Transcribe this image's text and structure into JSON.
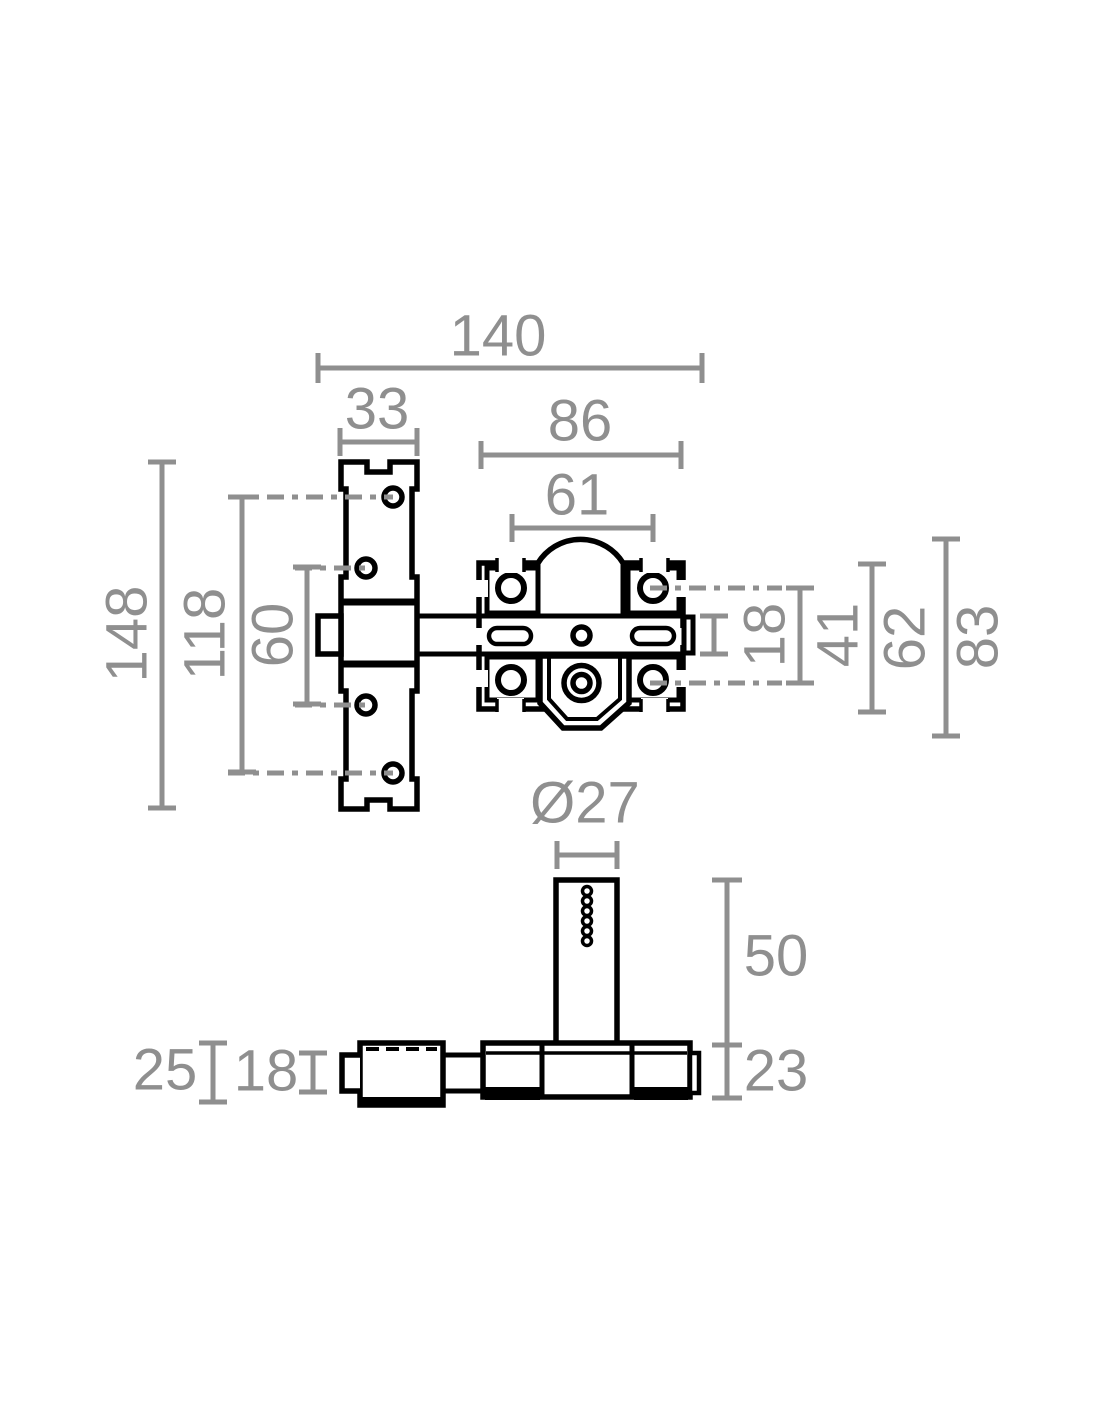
{
  "colors": {
    "ink": "#000000",
    "dimension_gray": "#8f8f8f",
    "background": "#ffffff"
  },
  "front_view": {
    "overall_width": "140",
    "keeper_plate_width": "33",
    "body_width": "86",
    "screw_spacing_horizontal": "61",
    "keeper_plate_height": "148",
    "outer_hole_spacing": "118",
    "inner_hole_spacing": "60",
    "bolt_height": "18",
    "screw_spacing_vertical": "41",
    "body_height": "62",
    "overall_height": "83"
  },
  "side_view": {
    "cylinder_diameter": "Ø27",
    "cylinder_height": "50",
    "bar_height": "23",
    "keeper_depth": "25",
    "rod_depth": "18"
  }
}
